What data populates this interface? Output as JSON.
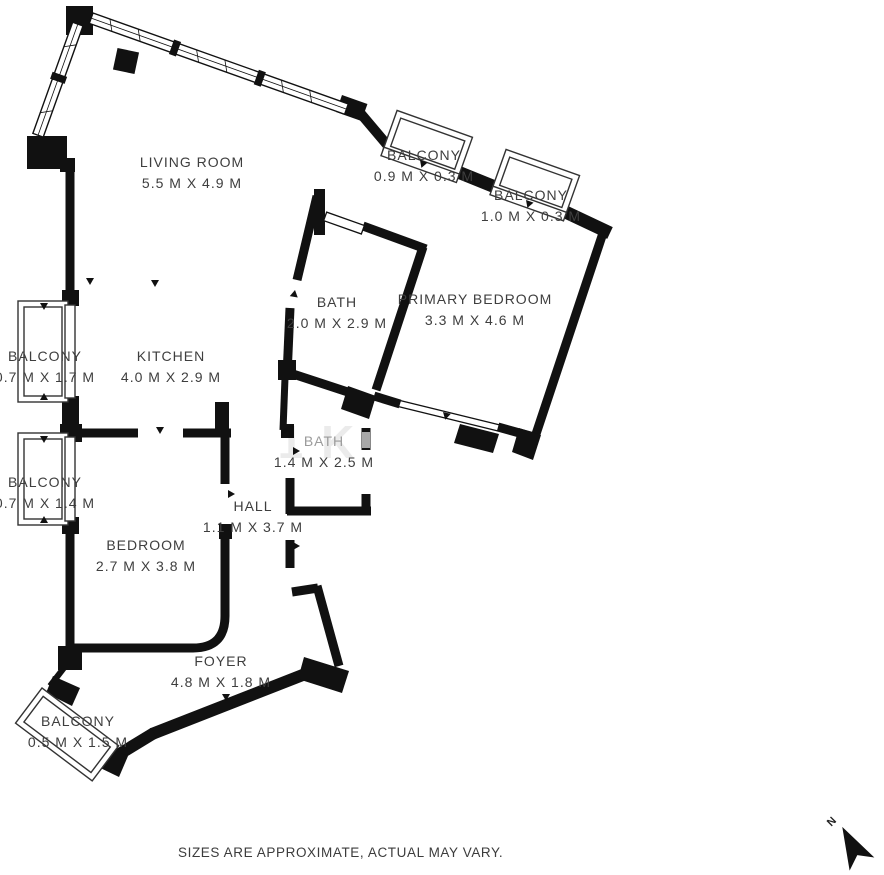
{
  "plan": {
    "rooms": [
      {
        "id": "living-room",
        "name": "LIVING ROOM",
        "dims": "5.5 M X 4.9 M"
      },
      {
        "id": "kitchen",
        "name": "KITCHEN",
        "dims": "4.0 M X 2.9 M"
      },
      {
        "id": "bath-main",
        "name": "BATH",
        "dims": "2.0 M X 2.9 M"
      },
      {
        "id": "primary-bedroom",
        "name": "PRIMARY BEDROOM",
        "dims": "3.3 M X 4.6 M"
      },
      {
        "id": "bath-small",
        "name": "BATH",
        "dims": "1.4 M X 2.5 M"
      },
      {
        "id": "hall",
        "name": "HALL",
        "dims": "1.1 M X 3.7 M"
      },
      {
        "id": "bedroom",
        "name": "BEDROOM",
        "dims": "2.7 M X 3.8 M"
      },
      {
        "id": "foyer",
        "name": "FOYER",
        "dims": "4.8 M X 1.8 M"
      },
      {
        "id": "balcony-top-1",
        "name": "BALCONY",
        "dims": "0.9 M X 0.3 M"
      },
      {
        "id": "balcony-top-2",
        "name": "BALCONY",
        "dims": "1.0 M X 0.3 M"
      },
      {
        "id": "balcony-left-1",
        "name": "BALCONY",
        "dims": "0.7 M X 1.7 M"
      },
      {
        "id": "balcony-left-2",
        "name": "BALCONY",
        "dims": "0.7 M X 1.4 M"
      },
      {
        "id": "balcony-bottom",
        "name": "BALCONY",
        "dims": "0.5 M X 1.5 M"
      }
    ],
    "disclaimer": "SIZES ARE APPROXIMATE, ACTUAL MAY VARY.",
    "north_label": "N",
    "watermark": "1K",
    "colors": {
      "wall": "#111111",
      "label_text": "#3e3e3e",
      "background": "#ffffff"
    }
  }
}
